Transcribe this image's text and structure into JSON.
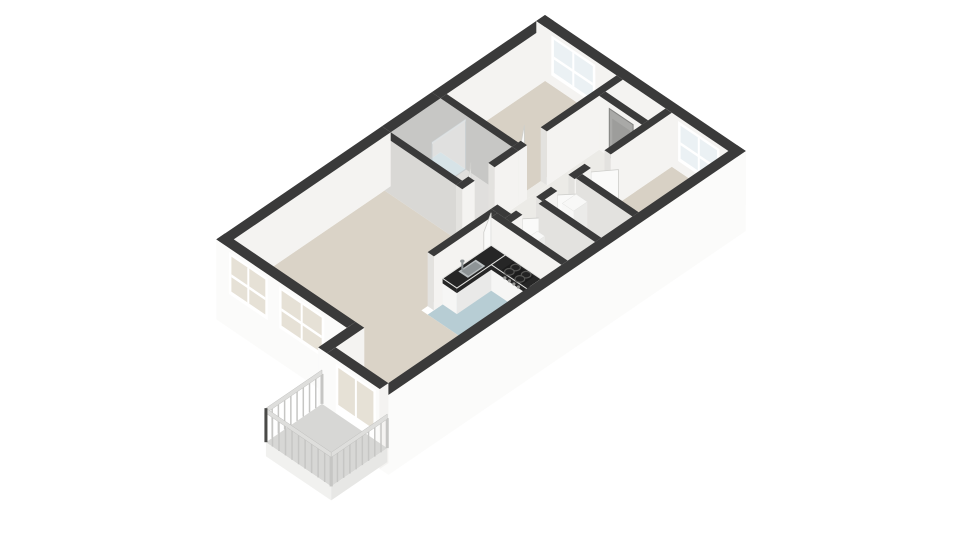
{
  "meta": {
    "name": "3D isometric floor plan of a two-bedroom apartment with balcony",
    "visible_text": []
  },
  "scene": {
    "width": 960,
    "height": 540,
    "projection": {
      "origin_x": 545,
      "origin_y": 69,
      "ax": -24.9,
      "ay": 17,
      "bx": 25.1,
      "by": 17,
      "wall_height_px": 54,
      "slab_depth_px": 26
    }
  },
  "palette": {
    "background": "#ffffff",
    "wall_top": "#3a3a3a",
    "ext_face": "#fbfbfa",
    "int_face_light": "#f4f3f1",
    "int_face": "#e3e2df",
    "int_face_shade": "#d9d8d5",
    "bath_face": "#c7c7c5",
    "floor_wood": "#d8d1c5",
    "floor_living": "#dad3c7",
    "floor_hall": "#ecebe7",
    "floor_service": "#eae8e4",
    "floor_closet": "#d6d4d0",
    "floor_bath": "#e0dfdd",
    "floor_wet": "#b7cdd4",
    "floor_balcony": "#d7d7d5",
    "slab": "#f1f1ef",
    "slab_shade": "#e7e7e5",
    "glass_cool": "#ebf1f4",
    "glass_warm": "#e6e1d6",
    "frame": "#ffffff",
    "counter_top": "#262626",
    "cabinet": "#f6f6f5",
    "cabinet_side": "#e9e9e8",
    "steel": "#b9bec0",
    "steel_dark": "#8e9496",
    "appliance": "#f8f8f7",
    "appliance_side": "#ebebe9",
    "stove": "#1c1c1c",
    "burner": "#555553",
    "rail": "#c6c6c4",
    "rail_light": "#dededc",
    "rail_post_dark": "#4a4a48",
    "door": "#fafaf9",
    "door_edge": "#cfcfcc",
    "door_gray": "#a9a9a7",
    "door_gray_inner": "#9d9d9b",
    "glass_screen": "#ffffff"
  },
  "apartment": {
    "length_units": 13.2,
    "width_units": 8,
    "rooms": [
      {
        "id": "bedroom-1",
        "floor": "floor_wood",
        "rect": [
          0.35,
          4.3,
          0.35,
          3.2
        ]
      },
      {
        "id": "bedroom-2",
        "floor": "floor_wood",
        "rect": [
          0.35,
          3.95,
          5.4,
          7.65
        ]
      },
      {
        "id": "bathroom",
        "floor": "floor_bath",
        "rect": [
          4.55,
          6.55,
          0.35,
          3.2
        ]
      },
      {
        "id": "bathroom-shower-floor",
        "floor": "floor_wet",
        "rect": [
          4.55,
          6.55,
          0.35,
          1.35
        ]
      },
      {
        "id": "hallway",
        "floor": "floor_hall",
        "rect": [
          1.3,
          6.8,
          3.45,
          5.15
        ]
      },
      {
        "id": "meter-closet",
        "floor": "floor_closet",
        "rect": [
          0.35,
          1.05,
          3.45,
          5.15
        ]
      },
      {
        "id": "utility-room",
        "floor": "floor_service",
        "rect": [
          4.2,
          5.45,
          5.4,
          7.65
        ]
      },
      {
        "id": "toilet-room",
        "floor": "floor_service",
        "rect": [
          5.7,
          6.8,
          5.4,
          7.65
        ]
      },
      {
        "id": "kitchen",
        "floor": "floor_wet",
        "rect": [
          7.05,
          9.6,
          4.85,
          7.65
        ]
      },
      {
        "id": "living-room",
        "floor": "floor_living",
        "poly": [
          [
            6.8,
            0.35
          ],
          [
            12.85,
            0.35
          ],
          [
            12.85,
            5.55
          ],
          [
            14.0,
            5.55
          ],
          [
            14.0,
            7.65
          ],
          [
            9.6,
            7.65
          ],
          [
            9.6,
            4.6
          ],
          [
            6.8,
            4.6
          ]
        ]
      }
    ],
    "thresholds": [
      {
        "rect": [
          3.4,
          4.2,
          3.2,
          3.45
        ],
        "floor": "floor_hall"
      },
      {
        "rect": [
          5.5,
          6.3,
          3.2,
          3.45
        ],
        "floor": "floor_hall"
      },
      {
        "rect": [
          2.8,
          3.6,
          5.15,
          5.4
        ],
        "floor": "floor_hall"
      },
      {
        "rect": [
          4.25,
          4.95,
          5.15,
          5.4
        ],
        "floor": "floor_hall"
      },
      {
        "rect": [
          5.55,
          6.35,
          5.15,
          5.4
        ],
        "floor": "floor_hall"
      },
      {
        "rect": [
          6.55,
          6.8,
          3.45,
          4.6
        ],
        "floor": "floor_living"
      }
    ],
    "walls": [
      {
        "id": "wall-exterior-ne",
        "r": [
          0,
          0.35,
          0,
          8
        ],
        "fa": "int_face_light",
        "fb": "ext_face",
        "win": [
          {
            "lo": 0.6,
            "hi": 2.35,
            "sill": 10,
            "top": 50,
            "glass": "glass_cool"
          },
          {
            "lo": 5.65,
            "hi": 7.3,
            "sill": 10,
            "top": 50,
            "glass": "glass_cool"
          }
        ]
      },
      {
        "id": "wall-exterior-nw-a",
        "r": [
          0,
          4.55,
          0,
          0.35
        ],
        "fb": "int_face_light"
      },
      {
        "id": "wall-exterior-nw-b",
        "r": [
          4.55,
          6.55,
          0,
          0.35
        ],
        "fb": "bath_face"
      },
      {
        "id": "wall-exterior-nw-c",
        "r": [
          6.55,
          13.2,
          0,
          0.35
        ],
        "fb": "int_face_light",
        "fa": "ext_face"
      },
      {
        "id": "wall-exterior-sw",
        "r": [
          12.85,
          13.2,
          0,
          5.2
        ],
        "fa": "ext_face",
        "slab": true,
        "win": [
          {
            "lo": 0.5,
            "hi": 2.05,
            "sill": 8,
            "top": 50,
            "glass": "glass_warm"
          },
          {
            "lo": 2.5,
            "hi": 4.3,
            "sill": 8,
            "top": 50,
            "glass": "glass_warm"
          }
        ]
      },
      {
        "id": "wall-bay-jog",
        "r": [
          12.85,
          14.35,
          5.2,
          5.55
        ],
        "fb": "int_face_light",
        "fa": "ext_face",
        "slab": true
      },
      {
        "id": "wall-bay-sw",
        "r": [
          14.0,
          14.35,
          5.55,
          7.65
        ],
        "fa": "ext_face",
        "slab": true,
        "win": [
          {
            "lo": 5.9,
            "hi": 7.5,
            "sill": 0,
            "top": 50,
            "glass": "glass_warm",
            "door": true
          }
        ]
      },
      {
        "id": "wall-exterior-se",
        "r": [
          0,
          14.35,
          7.65,
          8
        ],
        "fb": "ext_face",
        "fa": "ext_face",
        "slab": true
      },
      {
        "id": "wall-bed1-hall-a",
        "r": [
          0.35,
          3.4,
          3.2,
          3.45
        ]
      },
      {
        "id": "wall-bed1-hall-b",
        "r": [
          4.2,
          4.55,
          3.2,
          3.45
        ]
      },
      {
        "id": "wall-bed1-bath",
        "r": [
          4.3,
          4.55,
          0.35,
          3.2
        ],
        "fa": "bath_face"
      },
      {
        "id": "wall-bath-living",
        "r": [
          6.55,
          6.8,
          0.35,
          3.2
        ],
        "fa": "int_face_shade"
      },
      {
        "id": "wall-bath-hall-a",
        "r": [
          4.55,
          5.5,
          3.2,
          3.45
        ]
      },
      {
        "id": "wall-bath-hall-b",
        "r": [
          6.3,
          6.8,
          3.2,
          3.45
        ]
      },
      {
        "id": "wall-hall-se-a",
        "r": [
          0.35,
          2.8,
          5.15,
          5.4
        ]
      },
      {
        "id": "wall-hall-se-b",
        "r": [
          3.6,
          4.25,
          5.15,
          5.4
        ]
      },
      {
        "id": "wall-hall-se-c",
        "r": [
          4.95,
          5.55,
          5.15,
          5.4
        ]
      },
      {
        "id": "wall-hall-se-d",
        "r": [
          6.35,
          6.8,
          5.15,
          5.4
        ]
      },
      {
        "id": "wall-bed2-sw",
        "r": [
          3.95,
          4.2,
          5.4,
          7.65
        ]
      },
      {
        "id": "wall-utility-toilet",
        "r": [
          5.45,
          5.7,
          5.4,
          7.65
        ]
      },
      {
        "id": "wall-hall-living",
        "r": [
          6.55,
          6.8,
          4.6,
          5.15
        ],
        "fa": "int_face_light"
      },
      {
        "id": "wall-kitchen-nw",
        "r": [
          6.8,
          9.35,
          4.6,
          4.85
        ],
        "z": 12.8
      },
      {
        "id": "wall-kitchen-ne",
        "r": [
          6.8,
          7.05,
          4.85,
          7.65
        ],
        "fa": "int_face_light"
      },
      {
        "id": "wall-meter-closet",
        "r": [
          1.05,
          1.3,
          3.45,
          5.15
        ],
        "fa": "int_face_light",
        "panel": {
          "lo": 3.85,
          "hi": 4.8,
          "color": "door_gray"
        }
      }
    ],
    "doors": [
      {
        "id": "door-bedroom-1",
        "hinge": [
          4.2,
          3.2
        ],
        "end": [
          3.55,
          2.7
        ],
        "z": 6.0
      },
      {
        "id": "door-bathroom",
        "hinge": [
          6.3,
          3.2
        ],
        "end": [
          5.72,
          2.72
        ],
        "z": 8.3
      },
      {
        "id": "door-bedroom-2",
        "hinge": [
          3.6,
          5.4
        ],
        "end": [
          2.98,
          5.88
        ]
      },
      {
        "id": "door-utility",
        "hinge": [
          4.95,
          5.4
        ],
        "end": [
          4.42,
          5.86
        ]
      },
      {
        "id": "door-toilet",
        "hinge": [
          6.35,
          5.4
        ],
        "end": [
          5.82,
          5.86
        ],
        "z": 11.7
      },
      {
        "id": "door-living-room",
        "hinge": [
          6.8,
          4.6
        ],
        "end": [
          7.52,
          5.02
        ],
        "z": 12.9
      }
    ],
    "boxes": [
      {
        "id": "kitchen-counter-sink-run",
        "r": [
          7.05,
          9.0,
          4.85,
          5.42
        ],
        "h": [
          0,
          26
        ],
        "top": "counter_top",
        "edge": true,
        "z": 13.3
      },
      {
        "id": "kitchen-counter-stove-run",
        "r": [
          7.05,
          7.62,
          5.42,
          6.95
        ],
        "h": [
          0,
          26
        ],
        "top": "counter_top",
        "edge": true,
        "z": 13.52
      },
      {
        "id": "kitchen-low-cabinet",
        "r": [
          7.05,
          7.62,
          6.95,
          7.45
        ],
        "h": [
          0,
          30
        ],
        "top": "appliance",
        "ca": "appliance",
        "cb": "appliance_side",
        "z": 14.5
      },
      {
        "id": "bathroom-washbasin",
        "r": [
          6.22,
          6.55,
          1.5,
          2.1
        ],
        "h": [
          0,
          20
        ],
        "top": "appliance",
        "ca": "appliance",
        "cb": "appliance_side"
      },
      {
        "id": "toilet-cistern",
        "r": [
          6.0,
          6.5,
          5.65,
          5.95
        ],
        "h": [
          0,
          36
        ],
        "top": "appliance",
        "ca": "appliance",
        "cb": "appliance_side",
        "z": 12.3
      },
      {
        "id": "water-heater",
        "r": [
          4.55,
          5.1,
          5.75,
          6.2
        ],
        "h": [
          18,
          50
        ],
        "top": "appliance",
        "ca": "appliance",
        "cb": "appliance_side",
        "z": 10.8
      }
    ],
    "shower": {
      "glass_from": [
        4.55,
        1.35
      ],
      "glass_to": [
        5.9,
        1.35
      ],
      "height": 50
    },
    "toilet_bowl": {
      "center": [
        6.25,
        6.35
      ],
      "rx": 12,
      "ry": 8,
      "z": 12.6
    },
    "sink": {
      "rect": [
        7.78,
        8.48,
        4.96,
        5.34
      ],
      "h": 26,
      "faucet": [
        8.36,
        5.0
      ],
      "z": 13.35
    },
    "stove": {
      "rect": [
        7.12,
        7.56,
        5.78,
        6.62
      ],
      "h": 26,
      "burners": [
        [
          7.22,
          5.99
        ],
        [
          7.47,
          5.99
        ],
        [
          7.22,
          6.41
        ],
        [
          7.47,
          6.41
        ]
      ],
      "knobs_b": [
        5.9,
        6.08,
        6.26,
        6.44
      ],
      "z": 13.6
    },
    "balcony": {
      "floor_rect": [
        14.35,
        16.6,
        5.35,
        7.95
      ],
      "floor": "floor_balcony",
      "rail_height": 30,
      "sides": [
        {
          "id": "balcony-railing-nw",
          "p1": [
            14.35,
            5.35
          ],
          "p2": [
            16.6,
            5.35
          ],
          "z": 20.85
        },
        {
          "id": "balcony-railing-sw",
          "p1": [
            16.6,
            5.35
          ],
          "p2": [
            16.6,
            7.95
          ],
          "z": 23.3
        },
        {
          "id": "balcony-railing-se",
          "p1": [
            14.35,
            7.95
          ],
          "p2": [
            16.6,
            7.95
          ],
          "z": 23.45
        }
      ]
    }
  }
}
